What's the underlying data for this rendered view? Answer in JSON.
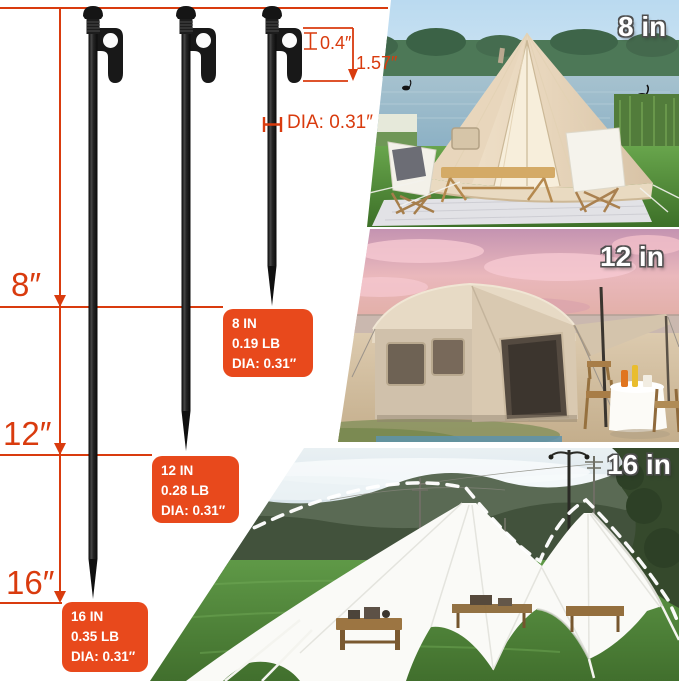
{
  "diagram": {
    "stake_length_labels": {
      "small": "8″",
      "medium": "12″",
      "large": "16″"
    },
    "hook_width_label": "0.4″",
    "hook_height_label": "1.57″",
    "shaft_diameter_label": "DIA: 0.31″"
  },
  "spec_boxes": [
    {
      "length": "8 IN",
      "weight": "0.19 LB",
      "diameter": "DIA: 0.31″"
    },
    {
      "length": "12 IN",
      "weight": "0.28 LB",
      "diameter": "DIA: 0.31″"
    },
    {
      "length": "16 IN",
      "weight": "0.35 LB",
      "diameter": "DIA: 0.31″"
    }
  ],
  "photo_labels": [
    "8 in",
    "12 in",
    "16 in"
  ],
  "colors": {
    "dimension_red": "#d93b0e",
    "spec_box_orange": "#e8491c",
    "stake_black": "#171717",
    "photo_label_white": "#ffffff"
  }
}
